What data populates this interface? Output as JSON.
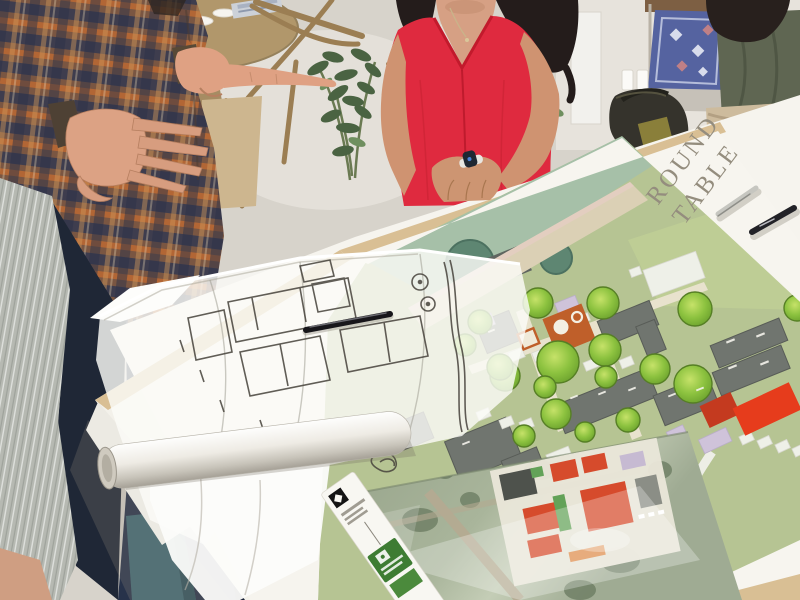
{
  "poster": {
    "title_line1": "ROUND",
    "title_line2": "TABLE"
  },
  "colors": {
    "accent_red_top": "#df2a3f",
    "table_leg_teal": "#416a75",
    "plan_red_building": "#e63c1c",
    "plan_red_building_dark": "#c43a1f",
    "poster_title_gray": "#948d7e",
    "strip_label_green": "#3e7c33",
    "tabletop_wood": "#d9bf94",
    "plan_field_green": "#b6c493",
    "tree_green": "#8cc23f",
    "orange_plaza": "#bf5f2a"
  }
}
